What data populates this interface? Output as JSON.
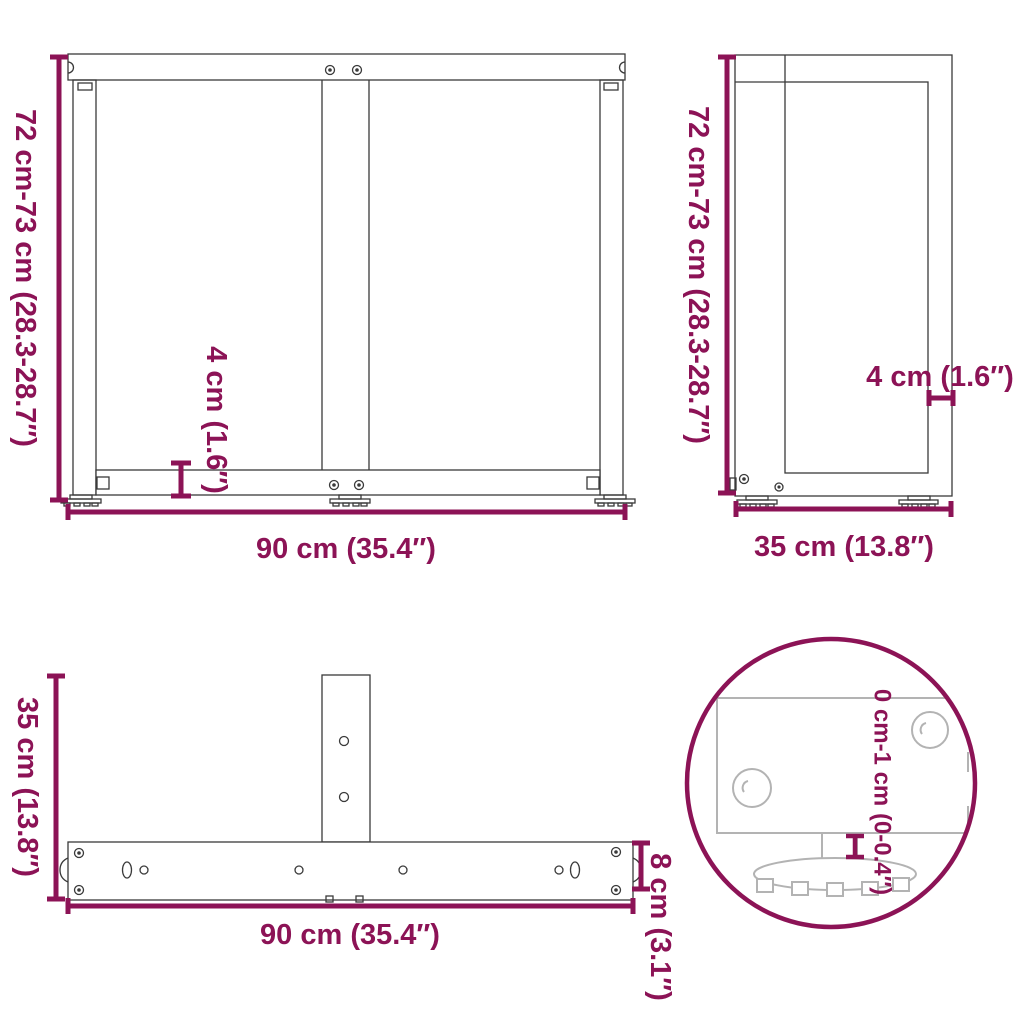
{
  "diagram": {
    "type": "furniture-dimension-diagram",
    "subject": "T-shaped table leg frame",
    "accent_color": "#8C1356",
    "line_color": "#3a3a3a",
    "detail_line_color": "#b3b3b3",
    "background_color": "#ffffff",
    "views": {
      "front": {
        "name": "front view",
        "height_label": "72 cm-73 cm (28.3-28.7″)",
        "width_label": "90 cm (35.4″)",
        "thickness_label": "4 cm (1.6″)"
      },
      "side": {
        "name": "side view",
        "height_label": "72 cm-73 cm (28.3-28.7″)",
        "depth_label": "35 cm (13.8″)",
        "thickness_label": "4 cm (1.6″)"
      },
      "top": {
        "name": "top (plan) view",
        "depth_label": "35 cm (13.8″)",
        "width_label": "90 cm (35.4″)",
        "bar_height_label": "8 cm (3.1″)"
      },
      "foot_detail": {
        "name": "adjustable foot zoom detail",
        "adjustable_label": "0 cm-1 cm (0-0.4″)"
      }
    }
  }
}
